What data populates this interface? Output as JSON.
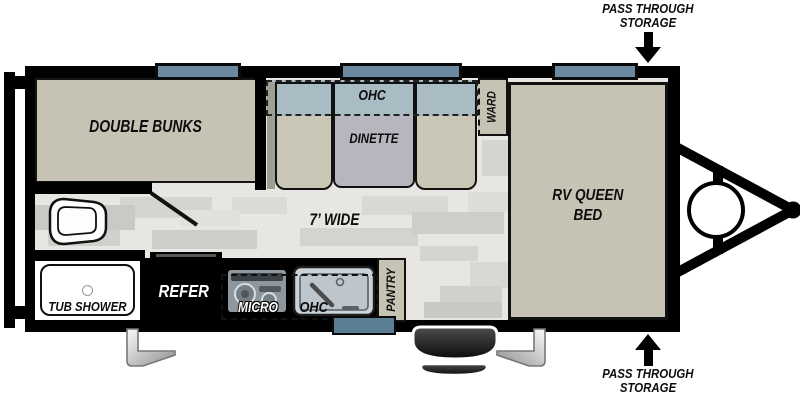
{
  "callouts": {
    "top": {
      "line1": "PASS THROUGH",
      "line2": "STORAGE"
    },
    "bottom": {
      "line1": "PASS THROUGH",
      "line2": "STORAGE"
    }
  },
  "rooms": {
    "double_bunks": "DOUBLE BUNKS",
    "dinette": "DINETTE",
    "dinette_ohc": "OHC",
    "ward": "WARD",
    "queen_line1": "RV QUEEN",
    "queen_line2": "BED",
    "width_label": "7’ WIDE",
    "tub_shower": "TUB SHOWER"
  },
  "kitchen": {
    "refer": "REFER",
    "micro": "MICRO",
    "ohc": "OHC",
    "pantry": "PANTRY"
  },
  "fixtures": [
    "rear-bumper",
    "toilet",
    "tub-shower",
    "refrigerator",
    "cooktop",
    "sink",
    "pantry",
    "wardrobe",
    "entry-door",
    "wheel",
    "stabilizer-jack-left",
    "stabilizer-jack-right",
    "propane-tank",
    "a-frame-hitch",
    "window-bunks",
    "window-dinette",
    "window-bed"
  ],
  "colors": {
    "wall": "#000000",
    "room_fill": "#c6c3b4",
    "bench_fill": "#cac7b7",
    "table_fill": "#b7b5bd",
    "overhead_cabinet_fill": "#a9bcc3",
    "window_fill": "#6b8aa1",
    "entry_door_fill": "#5c7e93",
    "floor_fill": "#e8e6e3",
    "tub_fill": "#ffffff"
  }
}
